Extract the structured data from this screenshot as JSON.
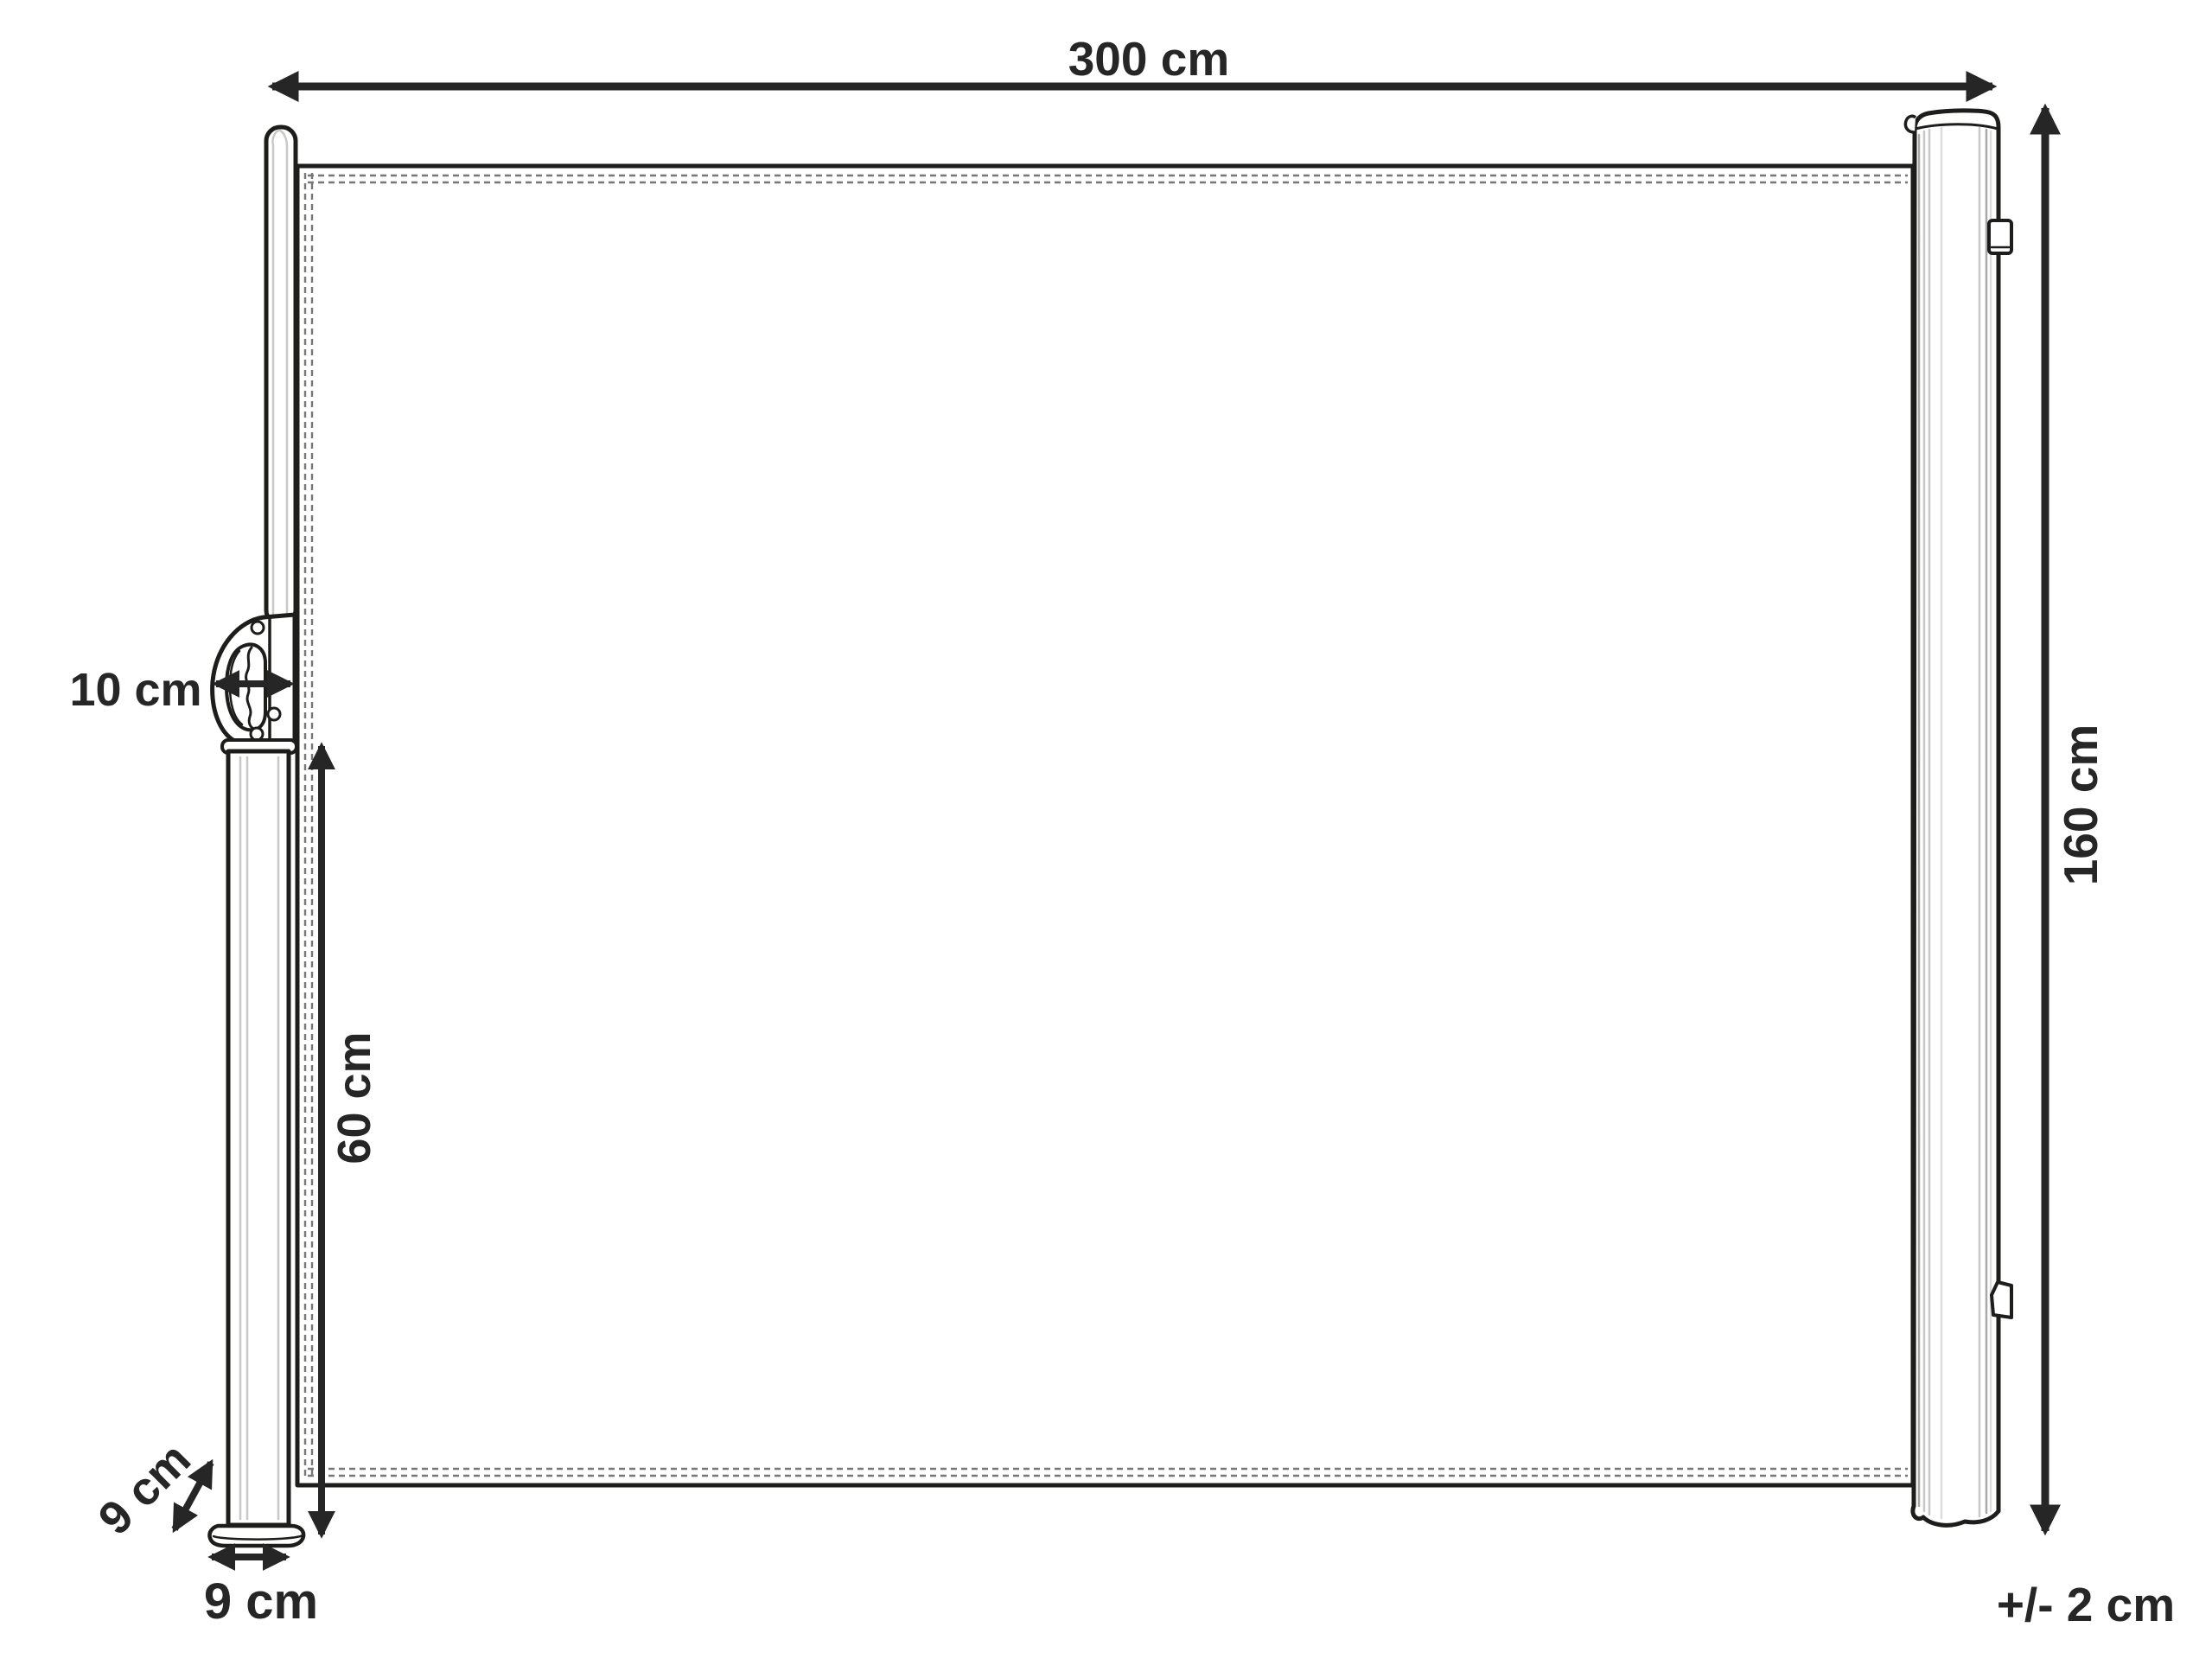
{
  "diagram": {
    "labels": {
      "width": "300 cm",
      "height": "160 cm",
      "handle_depth": "10 cm",
      "pole_height": "60 cm",
      "foot_depth": "9 cm",
      "foot_width": "9 cm",
      "height_tolerance": "+/- 2 cm"
    },
    "colors": {
      "outline": "#1d1d1b",
      "dimension": "#262626",
      "stitching": "#777777",
      "shading": "#c8c8c8",
      "background": "#ffffff"
    }
  }
}
